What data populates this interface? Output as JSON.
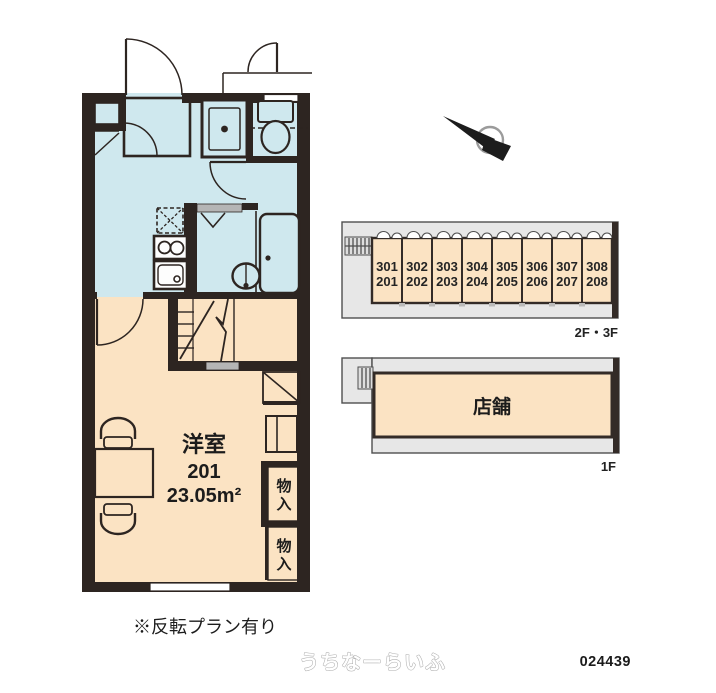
{
  "colors": {
    "wall": "#2d2521",
    "wet_area": "#cfe8ee",
    "living_area": "#fbe3c3",
    "site_gray": "#e7e7e7",
    "site_outline": "#332b27"
  },
  "floor_plan": {
    "room_type": "洋室",
    "room_number": "201",
    "area": "23.05m²",
    "storages": [
      {
        "chars": [
          "物",
          "入"
        ]
      },
      {
        "chars": [
          "物",
          "入"
        ]
      }
    ],
    "note": "※反転プラン有り"
  },
  "site_plans": {
    "upper": {
      "label": "2F・3F",
      "units": [
        {
          "top": "301",
          "bottom": "201"
        },
        {
          "top": "302",
          "bottom": "202"
        },
        {
          "top": "303",
          "bottom": "203"
        },
        {
          "top": "304",
          "bottom": "204"
        },
        {
          "top": "305",
          "bottom": "205"
        },
        {
          "top": "306",
          "bottom": "206"
        },
        {
          "top": "307",
          "bottom": "207"
        },
        {
          "top": "308",
          "bottom": "208"
        }
      ]
    },
    "lower": {
      "label": "1F",
      "store": "店舗"
    }
  },
  "footer": {
    "watermark": "うちなーらいふ",
    "plan_id": "024439"
  }
}
